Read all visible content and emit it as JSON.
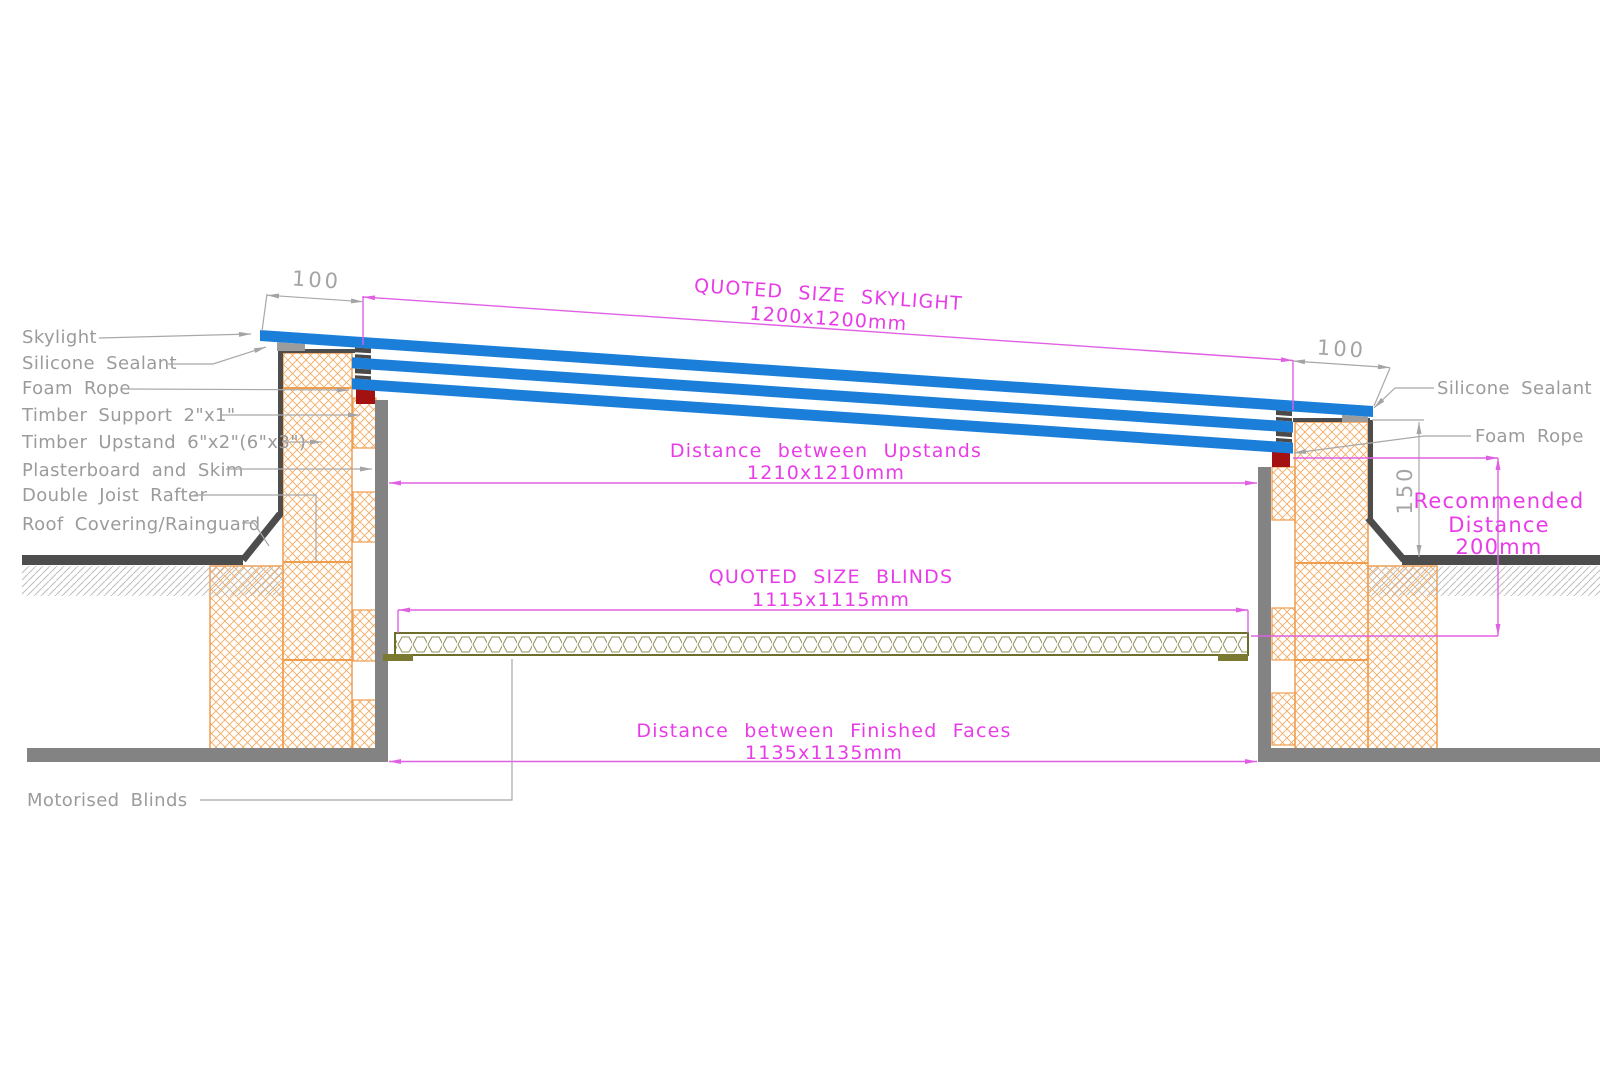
{
  "drawing": {
    "left_labels": {
      "skylight": "Skylight",
      "silicone_sealant": "Silicone Sealant",
      "foam_rope": "Foam Rope",
      "timber_support": "Timber Support 2\"x1\"",
      "timber_upstand": "Timber Upstand 6\"x2\"(6\"x3\")",
      "plasterboard": "Plasterboard and Skim",
      "double_joist": "Double Joist Rafter",
      "roof_covering": "Roof Covering/Rainguard",
      "motorised_blinds": "Motorised Blinds"
    },
    "right_labels": {
      "silicone_sealant": "Silicone Sealant",
      "foam_rope": "Foam Rope"
    },
    "dimensions": {
      "skylight_title": "QUOTED SIZE SKYLIGHT",
      "skylight_size": "1200x1200mm",
      "upstands_title": "Distance between Upstands",
      "upstands_size": "1210x1210mm",
      "blinds_title": "QUOTED SIZE BLINDS",
      "blinds_size": "1115x1115mm",
      "faces_title": "Distance between Finished Faces",
      "faces_size": "1135x1135mm",
      "recommended_line1": "Recommended",
      "recommended_line2": "Distance",
      "recommended_line3": "200mm",
      "overhang_left": "100",
      "overhang_right": "100",
      "upstand_height": "150"
    },
    "colors": {
      "glazing_blue": "#1b7ed9",
      "dimension_magenta": "#e83ce8",
      "label_gray": "#9b9b9b",
      "timber_hatch_orange": "#f2a95c",
      "foam_rope_red": "#a31111",
      "structure_dark": "#4d4d4d",
      "plasterboard_gray": "#838383",
      "blinds_olive": "#6e6e2b",
      "ground_hatch_gray": "#bdbdbd"
    }
  }
}
